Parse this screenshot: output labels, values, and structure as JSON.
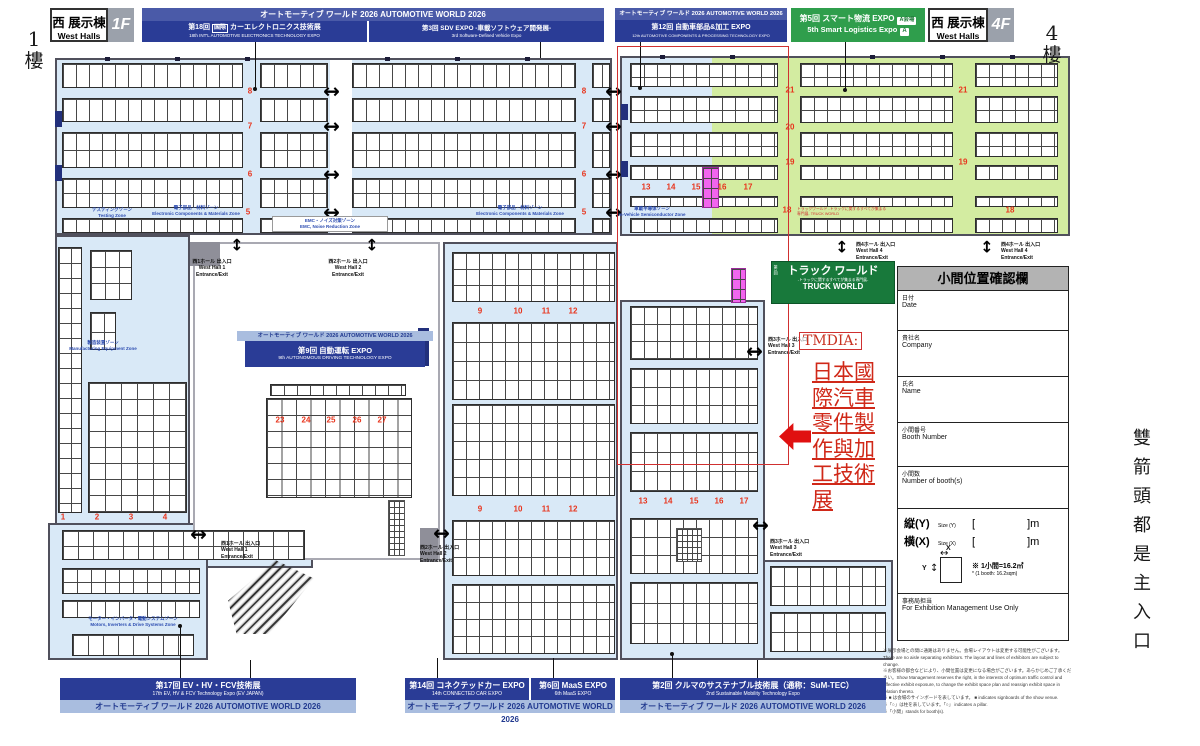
{
  "page": {
    "floor_left_num": "1",
    "floor_left_char": "樓",
    "floor_right_num": "4",
    "floor_right_char": "樓",
    "side_note": "雙箭頭都是主入口"
  },
  "header": {
    "aw_title": "オートモーティブ ワールド 2026  AUTOMOTIVE WORLD 2026",
    "west_left": {
      "jp": "西 展示棟",
      "en": "West Halls",
      "floor": "1F"
    },
    "west_right": {
      "jp": "西 展示棟",
      "en": "West Halls",
      "floor": "4F"
    },
    "expo18": {
      "num": "第18回",
      "badge": "国際",
      "jp": "カーエレクトロニクス技術展",
      "en": "18th INT'L AUTOMOTIVE ELECTRONICS TECHNOLOGY EXPO"
    },
    "sdv": {
      "jp": "第3回 SDV EXPO -車載ソフトウェア開発展-",
      "en": "3rd Software-Defined Vehicle Expo"
    },
    "expo12": {
      "jp": "第12回 自動車部品&加工 EXPO",
      "en": "12th AUTOMOTIVE COMPONENTS & PROCESSING TECHNOLOGY EXPO"
    },
    "logi": {
      "jp": "第5回 スマート物流 EXPO",
      "badge_jp": "A会場",
      "en": "5th Smart Logistics Expo",
      "badge_en": "A"
    }
  },
  "map": {
    "expo9": {
      "jp": "第9回 自動運転 EXPO",
      "en": "9th AUTONOMOUS DRIVING TECHNOLOGY EXPO"
    },
    "truck": {
      "num": "第1回",
      "jp": "トラック ワールド",
      "sub": "-トラックに関するすべてが集まる専門展-",
      "en": "TRUCK WORLD"
    },
    "truck_world_note": "トラックワールド -トラックに関するすべてが集まる専門展- TRUCK WORLD",
    "tmdia": {
      "label": "TMDIA:",
      "lines": [
        "日本國",
        "際汽車",
        "零件製",
        "作與加",
        "工技術",
        "展"
      ]
    },
    "arrow_glyphs": {
      "h": "↔",
      "v": "↕"
    },
    "aisle_numbers": [
      [
        "8",
        250,
        91
      ],
      [
        "7",
        250,
        126
      ],
      [
        "6",
        250,
        174
      ],
      [
        "5",
        248,
        212
      ],
      [
        "8",
        584,
        91
      ],
      [
        "7",
        584,
        126
      ],
      [
        "6",
        584,
        174
      ],
      [
        "5",
        584,
        212
      ],
      [
        "9",
        480,
        311
      ],
      [
        "10",
        518,
        311
      ],
      [
        "11",
        546,
        311
      ],
      [
        "12",
        573,
        311
      ],
      [
        "9",
        480,
        509
      ],
      [
        "10",
        518,
        509
      ],
      [
        "11",
        546,
        509
      ],
      [
        "12",
        573,
        509
      ],
      [
        "23",
        280,
        420
      ],
      [
        "24",
        306,
        420
      ],
      [
        "25",
        331,
        420
      ],
      [
        "26",
        357,
        420
      ],
      [
        "27",
        382,
        420
      ],
      [
        "1",
        63,
        517
      ],
      [
        "2",
        97,
        517
      ],
      [
        "3",
        131,
        517
      ],
      [
        "4",
        165,
        517
      ],
      [
        "13",
        646,
        187
      ],
      [
        "14",
        671,
        187
      ],
      [
        "15",
        696,
        187
      ],
      [
        "16",
        722,
        187
      ],
      [
        "17",
        748,
        187
      ],
      [
        "21",
        790,
        90
      ],
      [
        "21",
        963,
        90
      ],
      [
        "20",
        790,
        127
      ],
      [
        "19",
        790,
        162
      ],
      [
        "19",
        963,
        162
      ],
      [
        "18",
        787,
        210
      ],
      [
        "18",
        1010,
        210
      ],
      [
        "13",
        643,
        501
      ],
      [
        "14",
        668,
        501
      ],
      [
        "15",
        694,
        501
      ],
      [
        "16",
        719,
        501
      ],
      [
        "17",
        744,
        501
      ]
    ],
    "plain_arrows": [
      [
        331,
        91,
        "h"
      ],
      [
        331,
        126,
        "h"
      ],
      [
        331,
        174,
        "h"
      ],
      [
        331,
        212,
        "h"
      ],
      [
        613,
        91,
        "h"
      ],
      [
        613,
        126,
        "h"
      ],
      [
        613,
        174,
        "h"
      ],
      [
        613,
        212,
        "h"
      ]
    ],
    "entrances": [
      {
        "jp": "西1ホール 出入口",
        "en": "West Hall 1 Entrance/Exit",
        "x": 212,
        "y": 259,
        "ax": 237,
        "ay": 245,
        "d": "v",
        "w": 52
      },
      {
        "jp": "西2ホール 出入口",
        "en": "West Hall 2 Entrance/Exit",
        "x": 348,
        "y": 259,
        "ax": 372,
        "ay": 245,
        "d": "v",
        "w": 52
      },
      {
        "jp": "西4ホール 出入口",
        "en": "West Hall 4 Entrance/Exit",
        "x": 856,
        "y": 242,
        "ax": 842,
        "ay": 247,
        "d": "v",
        "w": 58,
        "al": "l"
      },
      {
        "jp": "西4ホール 出入口",
        "en": "West Hall 4 Entrance/Exit",
        "x": 1001,
        "y": 242,
        "ax": 987,
        "ay": 247,
        "d": "v",
        "w": 58,
        "al": "l"
      },
      {
        "jp": "西1ホール 出入口",
        "en": "West Hall 1 Entrance/Exit",
        "x": 221,
        "y": 541,
        "ax": 198,
        "ay": 534,
        "d": "h",
        "w": 40,
        "al": "l"
      },
      {
        "jp": "西2ホール 出入口",
        "en": "West Hall 2 Entrance/Exit",
        "x": 420,
        "y": 545,
        "ax": 441,
        "ay": 533,
        "d": "h",
        "w": 40,
        "al": "l"
      },
      {
        "jp": "西3ホール 出入口",
        "en": "West Hall 3 Entrance/Exit",
        "x": 768,
        "y": 337,
        "ax": 754,
        "ay": 351,
        "d": "h",
        "w": 40,
        "al": "l"
      },
      {
        "jp": "西3ホール 出入口",
        "en": "West Hall 3 Entrance/Exit",
        "x": 770,
        "y": 539,
        "ax": 760,
        "ay": 525,
        "d": "h",
        "w": 40,
        "al": "l"
      }
    ],
    "zone_labels": [
      {
        "jp": "テスティングゾーン",
        "en": "Testing Zone",
        "x": 112,
        "y": 207,
        "w": 56
      },
      {
        "jp": "電子部品・材料ゾーン",
        "en": "Electronic Components & Materials Zone",
        "x": 196,
        "y": 205,
        "w": 88
      },
      {
        "jp": "EMC・ノイズ対策ゾーン",
        "en": "EMC, Noise Reduction Zone",
        "x": 330,
        "y": 216,
        "w": 110,
        "boxed": true
      },
      {
        "jp": "電子部品・材料ゾーン",
        "en": "Electronic Components & Materials Zone",
        "x": 520,
        "y": 205,
        "w": 88
      },
      {
        "jp": "車載半導体ゾーン",
        "en": "In-Vehicle Semiconductor Zone",
        "x": 652,
        "y": 206,
        "w": 70
      },
      {
        "jp": "製造装置ゾーン",
        "en": "Manufacturing Equipment Zone",
        "x": 103,
        "y": 340,
        "w": 80
      },
      {
        "jp": "モーター・インバータ・電動システムゾーン",
        "en": "Motors, Inverters & Drive Systems Zone",
        "x": 133,
        "y": 616,
        "w": 115
      }
    ]
  },
  "form": {
    "header": "小間位置確認欄",
    "date": {
      "jp": "日付",
      "en": "Date"
    },
    "company": {
      "jp": "貴社名",
      "en": "Company"
    },
    "contact": {
      "jp": "氏名",
      "en": "Name"
    },
    "booth_no": {
      "jp": "小間番号",
      "en": "Booth Number"
    },
    "booth_count": {
      "jp": "小間数",
      "en": "Number of booth(s)"
    },
    "size_y": {
      "jp": "縦(Y)",
      "en": "Size (Y)"
    },
    "size_x": {
      "jp": "横(X)",
      "en": "Size (X)"
    },
    "br_open": "[",
    "br_close": "]m",
    "diag_x": "X",
    "diag_y": "Y",
    "note_jp": "※ 1小間=16.2㎡",
    "note_en": "* (1 booth: 16.2sqm)",
    "admin": {
      "jp": "事務局担当",
      "en": "For Exhibition Management Use Only"
    }
  },
  "footer": {
    "expo17": {
      "jp": "第17回 EV・HV・FCV技術展",
      "en": "17th EV, HV & FCV Technology Expo (EV JAPAN)"
    },
    "expo14": {
      "jp": "第14回 コネクテッドカー EXPO",
      "en": "14th CONNECTED CAR EXPO"
    },
    "expo6": {
      "jp": "第6回 MaaS EXPO",
      "en": "6th MaaS EXPO"
    },
    "expo2": {
      "jp": "第2回 クルマのサステナブル技術展（通称：SuM-TEC）",
      "en": "2nd Sustainable Mobility Technology Expo"
    }
  },
  "fine_print": [
    "※展示会場との間に通路はありません。会場レイアウトは変更する可能性がございます。There are no aisle separating exhibitors. The layout and lines of exhibitors are subject to change.",
    "※お客様の都合などにより、小間位置は変更になる場合がございます。あらかじめご了承ください。Show Management reserves the right, in the interests of optimum traffic control and effective exhibit exposure, to change the exhibit space plan and reassign exhibit space in relation thereto.",
    "※ ■ は会場のサインボードを表しています。 ■ indicates signboards of the show venue.",
    "※「○」は柱を表しています。「○」 indicates a pillar.",
    "※「小間」stands for booth(s)."
  ]
}
